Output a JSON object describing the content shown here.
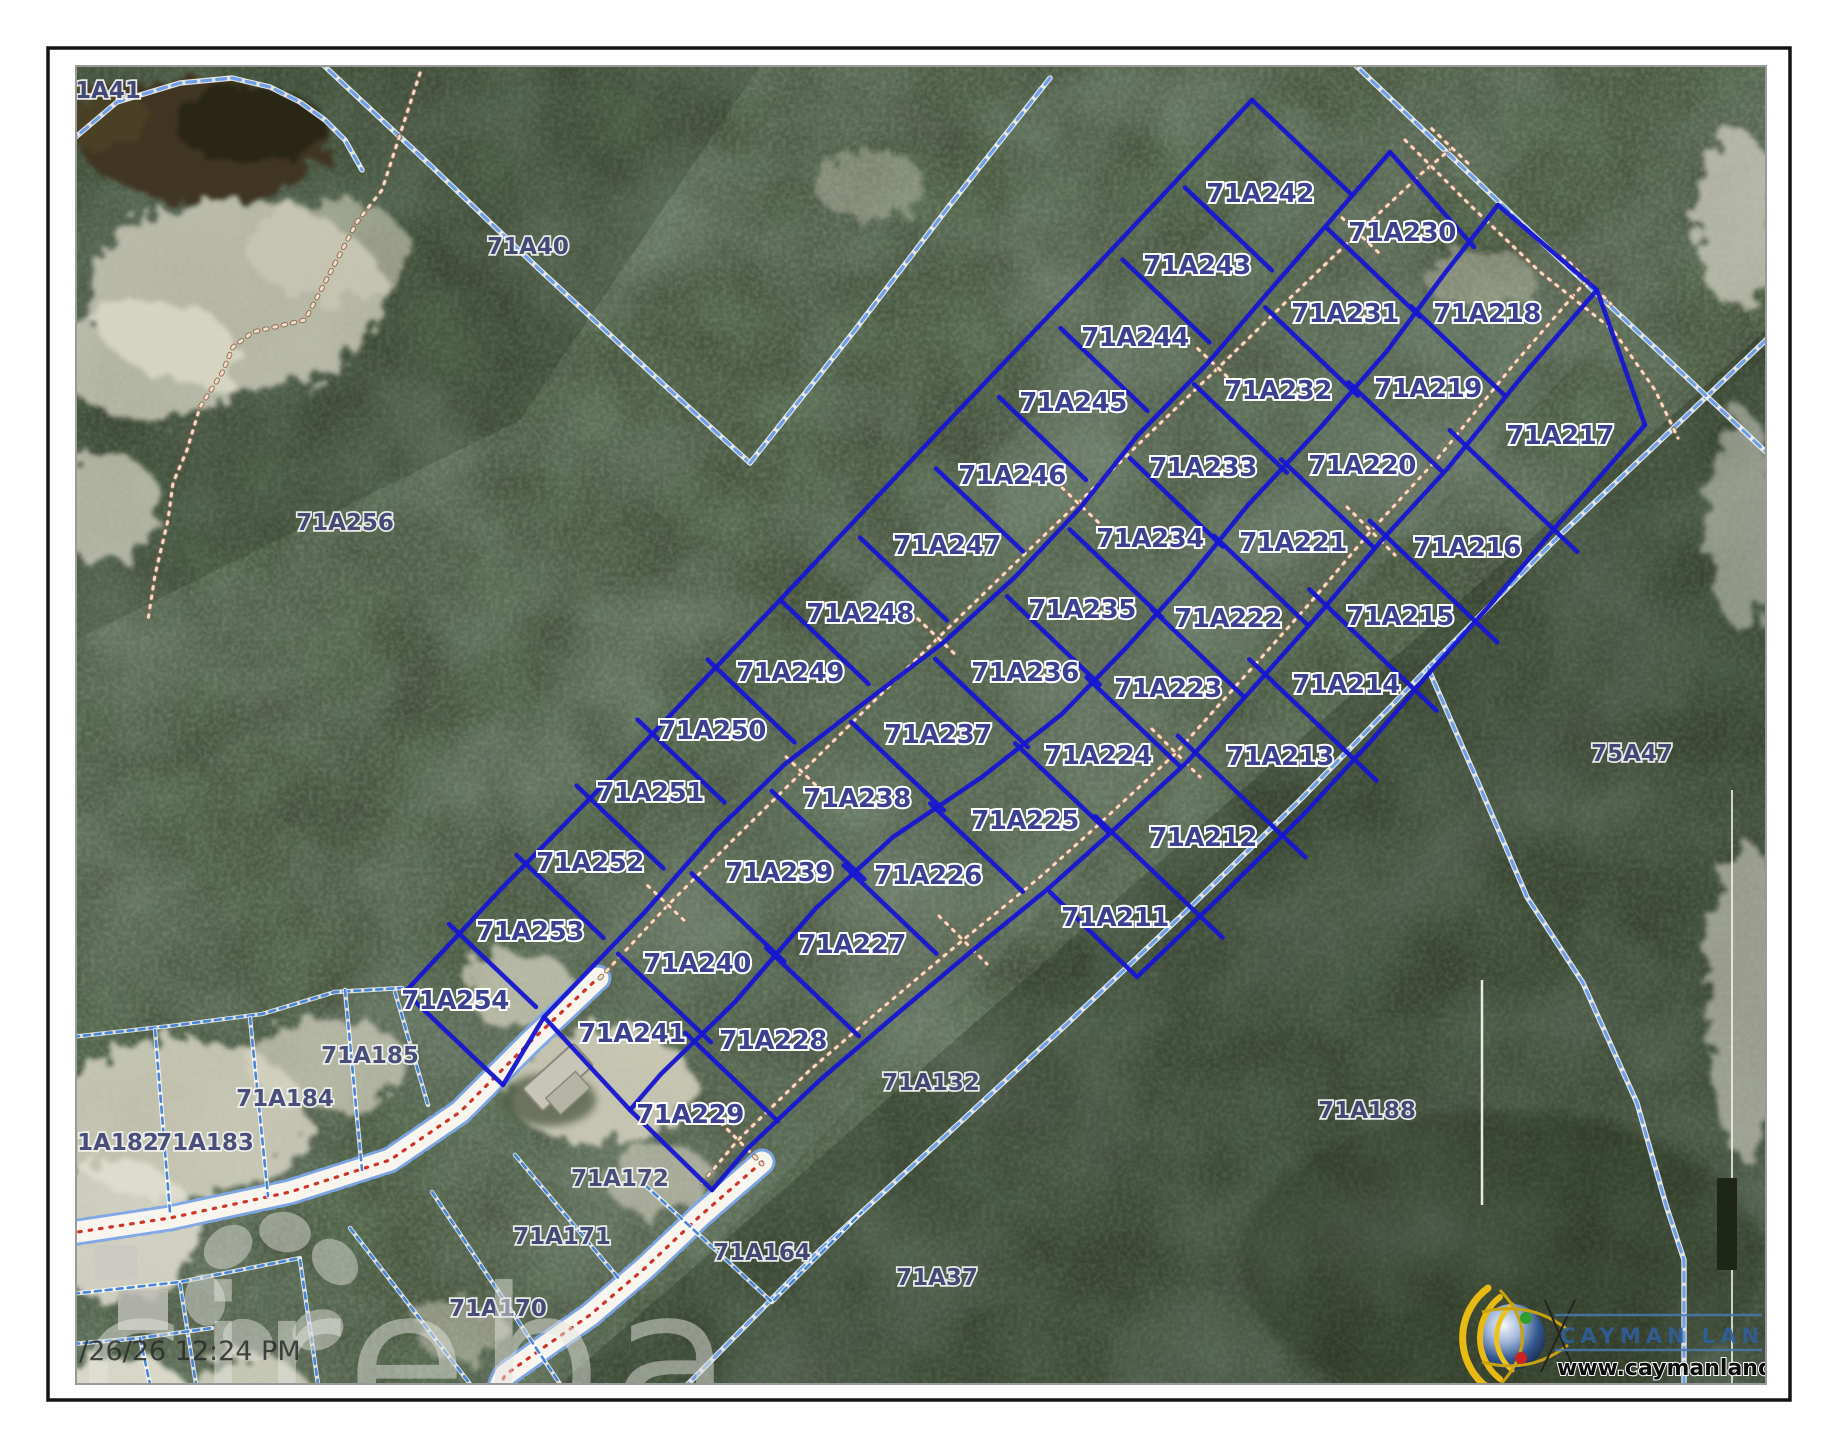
{
  "map": {
    "watermark_text": "cireba",
    "timestamp": "3/26/26 12:24 PM",
    "logo": {
      "title": "CAYMAN LAND INFO",
      "url": "www.caymanlandinfo.ky"
    },
    "colors": {
      "subdivision_line": "#1717d0",
      "boundary_line": "#6f9fe8",
      "label_fill": "#3b4090",
      "road_centerline": "#cc2a1e",
      "survey_dots": "#f5dcc6"
    },
    "parcels": {
      "subdivision": [
        {
          "id": "71A242",
          "x": 1260,
          "y": 193
        },
        {
          "id": "71A243",
          "x": 1197,
          "y": 265
        },
        {
          "id": "71A244",
          "x": 1135,
          "y": 337
        },
        {
          "id": "71A245",
          "x": 1073,
          "y": 402
        },
        {
          "id": "71A246",
          "x": 1012,
          "y": 475
        },
        {
          "id": "71A247",
          "x": 947,
          "y": 545
        },
        {
          "id": "71A248",
          "x": 860,
          "y": 613
        },
        {
          "id": "71A249",
          "x": 790,
          "y": 672
        },
        {
          "id": "71A250",
          "x": 712,
          "y": 730
        },
        {
          "id": "71A251",
          "x": 650,
          "y": 792
        },
        {
          "id": "71A252",
          "x": 590,
          "y": 862
        },
        {
          "id": "71A253",
          "x": 530,
          "y": 931
        },
        {
          "id": "71A254",
          "x": 455,
          "y": 1000
        },
        {
          "id": "71A230",
          "x": 1402,
          "y": 232
        },
        {
          "id": "71A231",
          "x": 1345,
          "y": 313
        },
        {
          "id": "71A232",
          "x": 1278,
          "y": 390
        },
        {
          "id": "71A233",
          "x": 1203,
          "y": 467
        },
        {
          "id": "71A234",
          "x": 1150,
          "y": 538
        },
        {
          "id": "71A235",
          "x": 1082,
          "y": 609
        },
        {
          "id": "71A236",
          "x": 1025,
          "y": 672
        },
        {
          "id": "71A237",
          "x": 938,
          "y": 734
        },
        {
          "id": "71A238",
          "x": 857,
          "y": 798
        },
        {
          "id": "71A239",
          "x": 779,
          "y": 872
        },
        {
          "id": "71A240",
          "x": 697,
          "y": 963
        },
        {
          "id": "71A241",
          "x": 632,
          "y": 1033
        },
        {
          "id": "71A218",
          "x": 1487,
          "y": 313
        },
        {
          "id": "71A219",
          "x": 1428,
          "y": 388
        },
        {
          "id": "71A220",
          "x": 1362,
          "y": 465
        },
        {
          "id": "71A221",
          "x": 1293,
          "y": 542
        },
        {
          "id": "71A222",
          "x": 1228,
          "y": 618
        },
        {
          "id": "71A223",
          "x": 1168,
          "y": 688
        },
        {
          "id": "71A224",
          "x": 1098,
          "y": 755
        },
        {
          "id": "71A225",
          "x": 1025,
          "y": 820
        },
        {
          "id": "71A226",
          "x": 928,
          "y": 875
        },
        {
          "id": "71A227",
          "x": 852,
          "y": 944
        },
        {
          "id": "71A228",
          "x": 773,
          "y": 1040
        },
        {
          "id": "71A229",
          "x": 690,
          "y": 1114
        },
        {
          "id": "71A217",
          "x": 1560,
          "y": 435
        },
        {
          "id": "71A216",
          "x": 1467,
          "y": 547
        },
        {
          "id": "71A215",
          "x": 1400,
          "y": 616
        },
        {
          "id": "71A214",
          "x": 1346,
          "y": 684
        },
        {
          "id": "71A213",
          "x": 1280,
          "y": 756
        },
        {
          "id": "71A212",
          "x": 1203,
          "y": 837
        },
        {
          "id": "71A211",
          "x": 1115,
          "y": 917
        }
      ],
      "surrounding": [
        {
          "id": "71A41",
          "x": 100,
          "y": 90
        },
        {
          "id": "71A40",
          "x": 528,
          "y": 246
        },
        {
          "id": "71A256",
          "x": 345,
          "y": 522
        },
        {
          "id": "75A47",
          "x": 1632,
          "y": 753
        },
        {
          "id": "71A188",
          "x": 1367,
          "y": 1110
        },
        {
          "id": "71A132",
          "x": 931,
          "y": 1082
        },
        {
          "id": "71A37",
          "x": 937,
          "y": 1277
        },
        {
          "id": "71A185",
          "x": 370,
          "y": 1055
        },
        {
          "id": "71A184",
          "x": 285,
          "y": 1098
        },
        {
          "id": "71A183",
          "x": 205,
          "y": 1142
        },
        {
          "id": "71A182",
          "x": 110,
          "y": 1142
        },
        {
          "id": "71A172",
          "x": 620,
          "y": 1178
        },
        {
          "id": "71A171",
          "x": 562,
          "y": 1236
        },
        {
          "id": "71A170",
          "x": 498,
          "y": 1308
        },
        {
          "id": "71A164",
          "x": 762,
          "y": 1252
        }
      ]
    }
  }
}
